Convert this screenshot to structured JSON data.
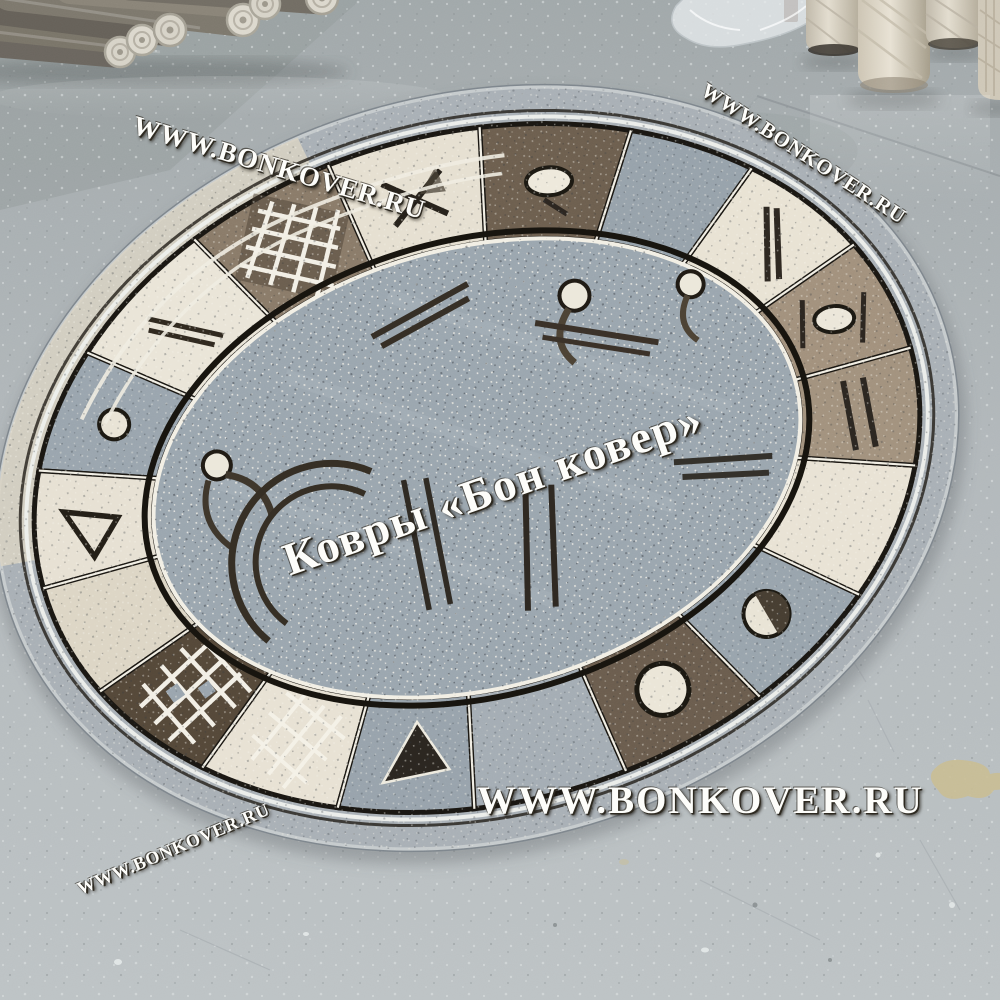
{
  "watermarks": {
    "top_left": "WWW.BONKOVER.RU",
    "top_right": "WWW.BONKOVER.RU",
    "center": "Ковры «Бон ковер»",
    "bottom": "WWW.BONKOVER.RU",
    "bottom_left": "WWW.BONKOVER.RU"
  },
  "scene": {
    "subject": "oval rug with abstract geometric pattern on grey concrete warehouse floor",
    "colors": {
      "floor": "#b3b9bc",
      "rug_field": "#9ba6af",
      "rug_margin": "#a9b0b6",
      "panel_cream": "#e9e3d4",
      "panel_gray": "#97a2ab",
      "panel_taupe": "#a2917d",
      "panel_brown": "#6d5f4f",
      "panel_dark_brown": "#554839",
      "pattern_outline": "#17150f",
      "white_line": "#f2efe5",
      "rolled_carpets": "#6e6961",
      "standing_rolls": "#d6cfc0"
    }
  }
}
